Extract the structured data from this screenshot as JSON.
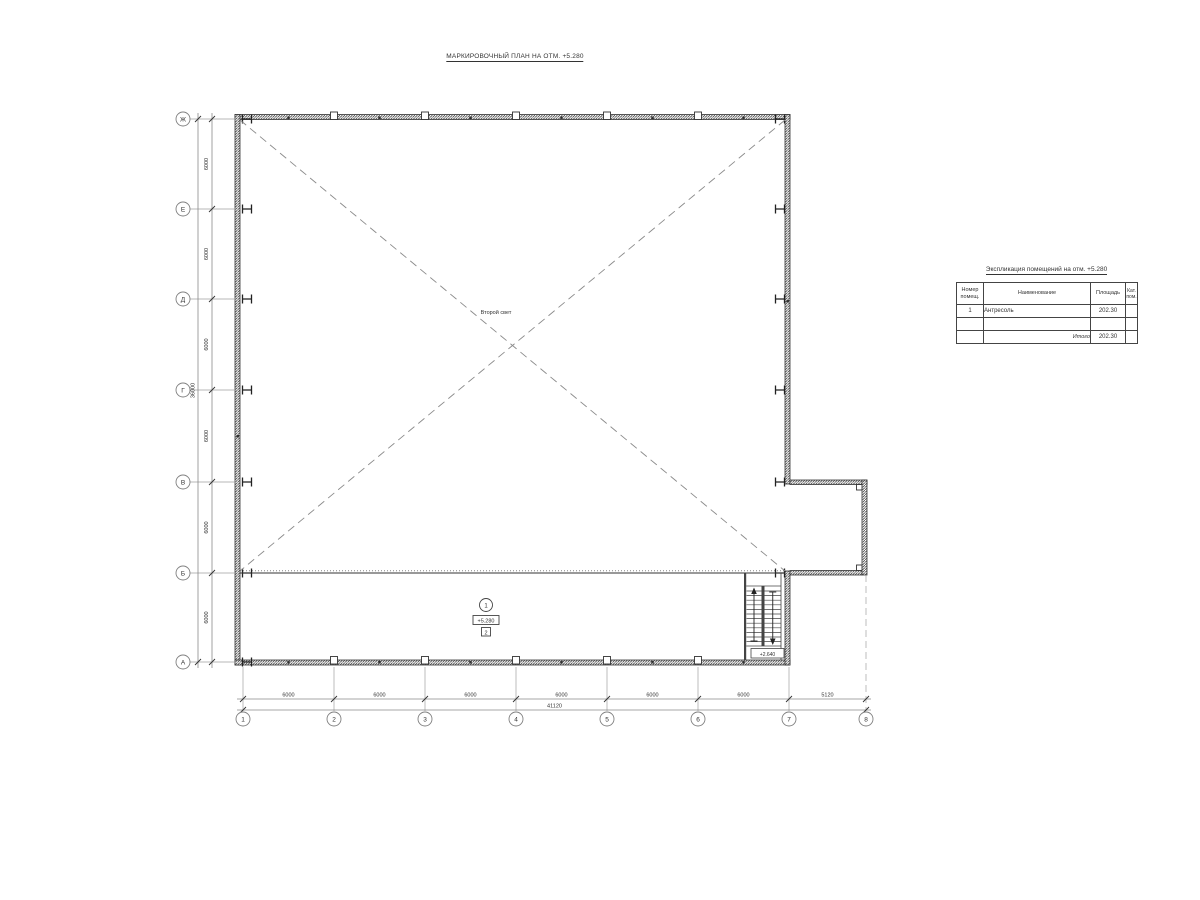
{
  "page": {
    "title": "МАРКИРОВОЧНЫЙ ПЛАН НА ОТМ. +5.280"
  },
  "axes": {
    "rows": [
      {
        "label": "Ж"
      },
      {
        "label": "Е"
      },
      {
        "label": "Д"
      },
      {
        "label": "Г"
      },
      {
        "label": "В"
      },
      {
        "label": "Б"
      },
      {
        "label": "А"
      }
    ],
    "cols": [
      {
        "label": "1"
      },
      {
        "label": "2"
      },
      {
        "label": "3"
      },
      {
        "label": "4"
      },
      {
        "label": "5"
      },
      {
        "label": "6"
      },
      {
        "label": "7"
      },
      {
        "label": "8"
      }
    ]
  },
  "dims": {
    "left_segments": [
      {
        "value": "6000"
      },
      {
        "value": "6000"
      },
      {
        "value": "6000"
      },
      {
        "value": "6000"
      },
      {
        "value": "6000"
      },
      {
        "value": "6000"
      }
    ],
    "left_total": "36000",
    "bottom_segments": [
      {
        "value": "6000"
      },
      {
        "value": "6000"
      },
      {
        "value": "6000"
      },
      {
        "value": "6000"
      },
      {
        "value": "6000"
      },
      {
        "value": "6000"
      },
      {
        "value": "5120"
      }
    ],
    "bottom_total": "41120"
  },
  "plan": {
    "void_label": "Второй свет",
    "room": {
      "number": "1",
      "elevation": "+5.280",
      "floor_type": "2"
    },
    "stair_elevation": "+2.640"
  },
  "table": {
    "title": "Экспликация помещений на отм. +5.280",
    "headers": [
      {
        "l1": "Номер",
        "l2": "помещ."
      },
      {
        "l1": "Наименование",
        "l2": ""
      },
      {
        "l1": "Площадь",
        "l2": ""
      },
      {
        "l1": "Кат.",
        "l2": "пом."
      }
    ],
    "rows": [
      {
        "number": "1",
        "name": "Антресоль",
        "area": "202.30",
        "category": ""
      }
    ],
    "total": {
      "label": "Итого",
      "area": "202.30"
    }
  },
  "colors": {
    "wall_line": "#333333",
    "axis_line": "#8a8a8a",
    "text": "#333333"
  }
}
